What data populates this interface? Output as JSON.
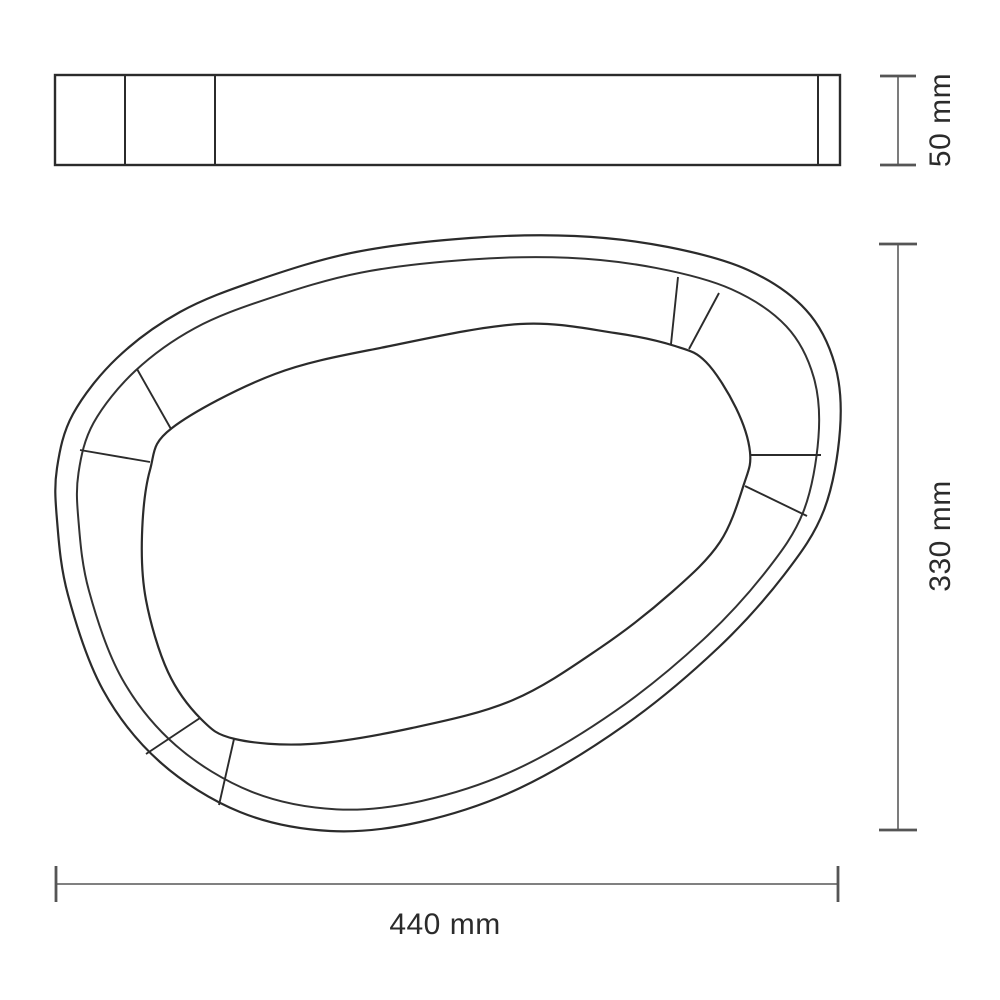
{
  "page": {
    "background": "#ffffff",
    "description": "Technical dimension drawing: side profile and plan view of an organic pebble-shaped frame"
  },
  "drawing": {
    "stroke_color": "#2b2b2b",
    "rim_stroke_color": "#323232",
    "dim_line_color": "#6e6e6e",
    "tick_color": "#555555",
    "text_color": "#2b2b2b",
    "side_view": {
      "x": 55,
      "y": 75,
      "width": 785,
      "height": 90,
      "dividers_x": [
        125,
        215,
        818
      ]
    },
    "plan_view": {
      "outer_points": [
        [
          57,
          468
        ],
        [
          73,
          414
        ],
        [
          117,
          358
        ],
        [
          180,
          312
        ],
        [
          258,
          280
        ],
        [
          356,
          252
        ],
        [
          470,
          238
        ],
        [
          575,
          236
        ],
        [
          668,
          247
        ],
        [
          748,
          270
        ],
        [
          806,
          310
        ],
        [
          835,
          365
        ],
        [
          840,
          430
        ],
        [
          824,
          510
        ],
        [
          784,
          575
        ],
        [
          718,
          648
        ],
        [
          625,
          725
        ],
        [
          520,
          788
        ],
        [
          420,
          822
        ],
        [
          330,
          831
        ],
        [
          240,
          812
        ],
        [
          160,
          762
        ],
        [
          103,
          690
        ],
        [
          68,
          595
        ],
        [
          57,
          520
        ]
      ],
      "rim_scale": {
        "cx": 448,
        "cy": 534,
        "sx": 0.945,
        "sy": 0.927
      },
      "inner_points": [
        [
          172,
          428
        ],
        [
          275,
          374
        ],
        [
          390,
          346
        ],
        [
          520,
          324
        ],
        [
          615,
          333
        ],
        [
          675,
          346
        ],
        [
          706,
          362
        ],
        [
          736,
          408
        ],
        [
          750,
          452
        ],
        [
          744,
          484
        ],
        [
          720,
          542
        ],
        [
          672,
          592
        ],
        [
          600,
          648
        ],
        [
          513,
          700
        ],
        [
          412,
          728
        ],
        [
          310,
          744
        ],
        [
          235,
          739
        ],
        [
          201,
          719
        ],
        [
          168,
          672
        ],
        [
          146,
          600
        ],
        [
          142,
          535
        ],
        [
          150,
          470
        ]
      ],
      "segment_dividers": [
        [
          [
            137,
            369
          ],
          [
            171,
            429
          ]
        ],
        [
          [
            80,
            450
          ],
          [
            150,
            462
          ]
        ],
        [
          [
            678,
            277
          ],
          [
            671,
            344
          ]
        ],
        [
          [
            719,
            293
          ],
          [
            689,
            349
          ]
        ],
        [
          [
            821,
            455
          ],
          [
            751,
            455
          ]
        ],
        [
          [
            807,
            516
          ],
          [
            745,
            486
          ]
        ],
        [
          [
            146,
            754
          ],
          [
            200,
            718
          ]
        ],
        [
          [
            219,
            805
          ],
          [
            234,
            739
          ]
        ]
      ]
    },
    "dimensions": [
      {
        "id": "depth",
        "label": "50 mm",
        "orientation": "vertical",
        "x": 898,
        "from": 76,
        "to": 165,
        "tick_half": 18,
        "label_x": 941,
        "label_y": 120
      },
      {
        "id": "height",
        "label": "330 mm",
        "orientation": "vertical",
        "x": 898,
        "from": 244,
        "to": 830,
        "tick_half": 19,
        "label_x": 941,
        "label_y": 536
      },
      {
        "id": "width",
        "label": "440 mm",
        "orientation": "horizontal",
        "y": 884,
        "from": 56,
        "to": 838,
        "tick_half": 18,
        "label_x": 445,
        "label_y": 925
      }
    ]
  }
}
